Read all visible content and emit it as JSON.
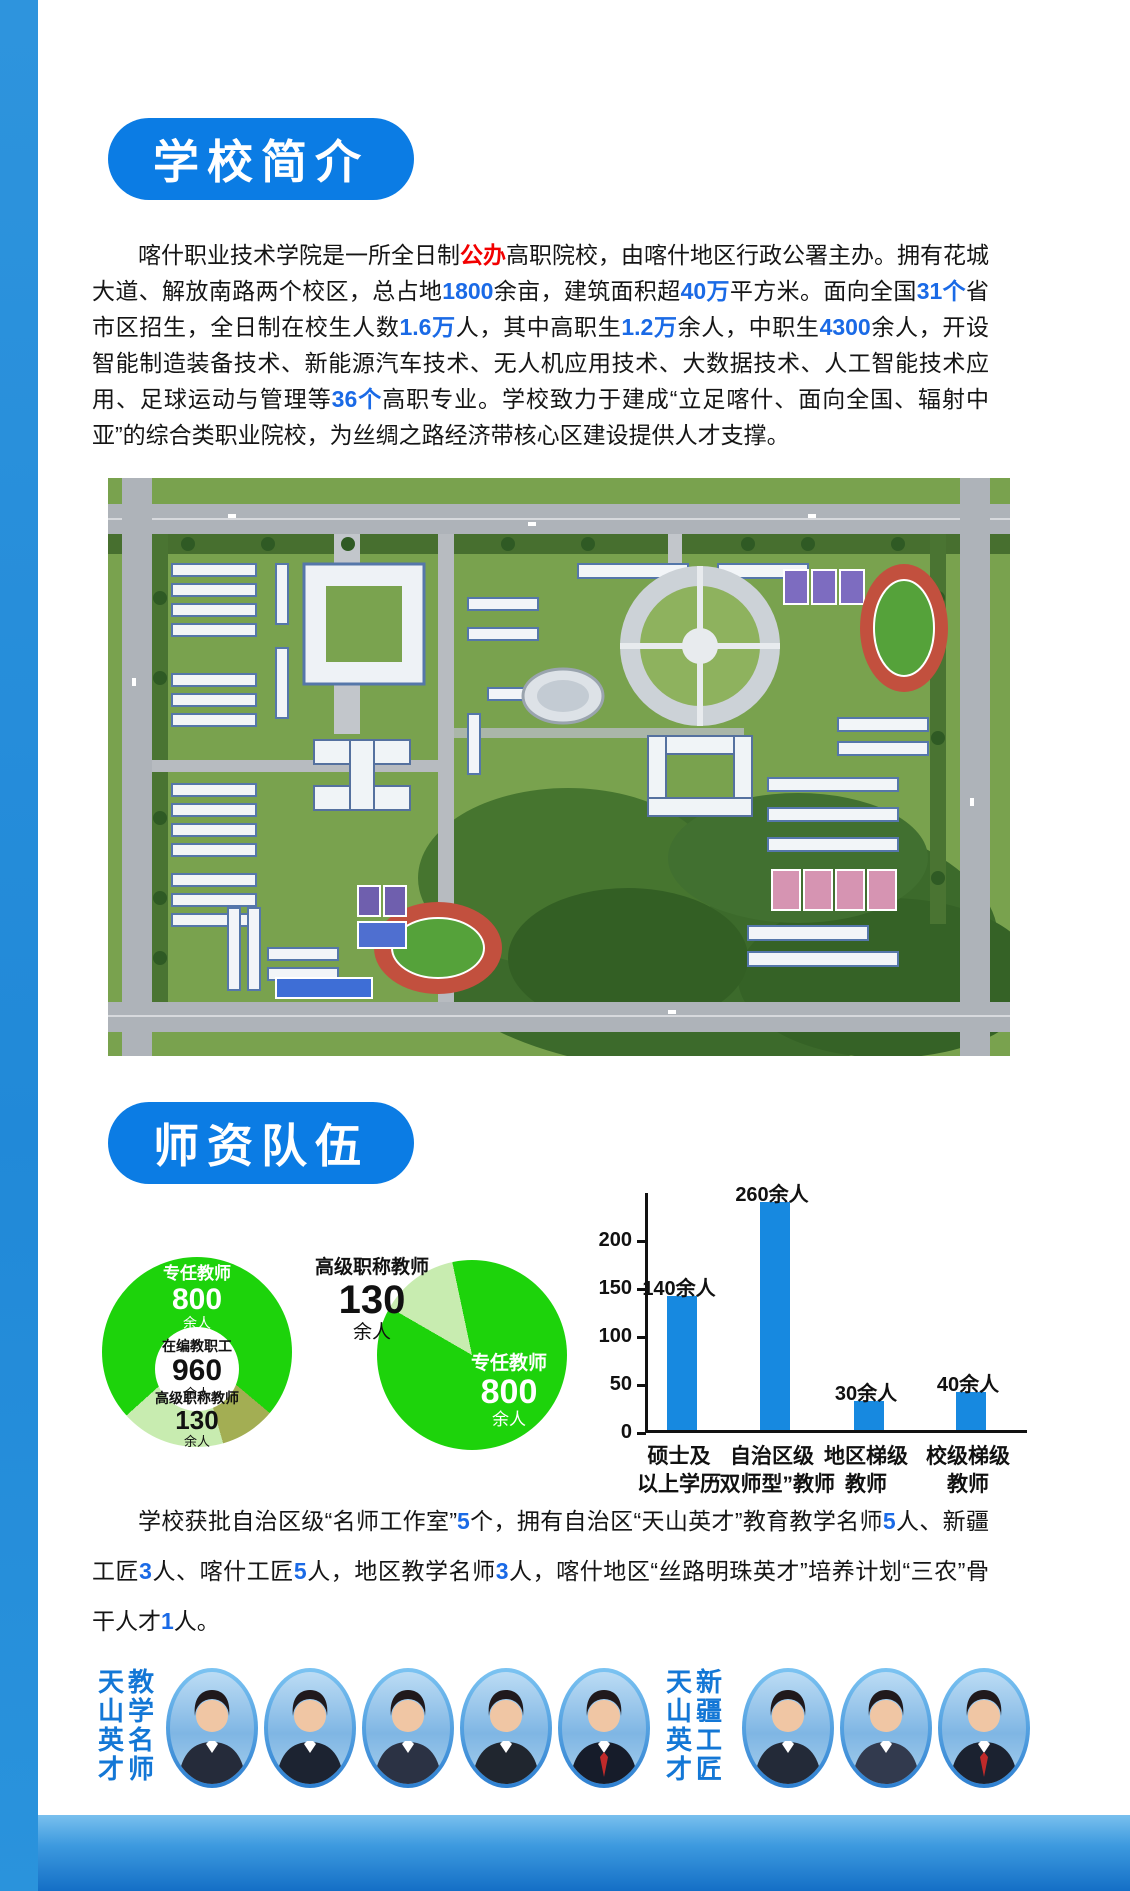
{
  "colors": {
    "accent_blue": "#0b7ce4",
    "number_blue": "#1a6ae6",
    "number_red": "#f20000",
    "bar_blue": "#1789e0",
    "pie_green": "#1dd30b",
    "pie_light_green": "#c8ecb0",
    "pie_olive": "#a3ae53",
    "honor_label_blue": "#1377d6"
  },
  "intro": {
    "badge": "学校简介",
    "paragraph": [
      {
        "t": "喀什职业技术学院是一所全日制"
      },
      {
        "t": "公办",
        "c": "red"
      },
      {
        "t": "高职院校，由喀什地区行政公署主办。拥有花城大道、解放南路两个校区，总占地"
      },
      {
        "t": "1800",
        "c": "blue"
      },
      {
        "t": "余亩，建筑面积超"
      },
      {
        "t": "40万",
        "c": "blue"
      },
      {
        "t": "平方米。面向全国"
      },
      {
        "t": "31个",
        "c": "blue"
      },
      {
        "t": "省市区招生，全日制在校生人数"
      },
      {
        "t": "1.6万",
        "c": "blue"
      },
      {
        "t": "人，其中高职生"
      },
      {
        "t": "1.2万",
        "c": "blue"
      },
      {
        "t": "余人，中职生"
      },
      {
        "t": "4300",
        "c": "blue"
      },
      {
        "t": "余人，开设智能制造装备技术、新能源汽车技术、无人机应用技术、大数据技术、人工智能技术应用、足球运动与管理等"
      },
      {
        "t": "36个",
        "c": "blue"
      },
      {
        "t": "高职专业。学校致力于建成“立足喀什、面向全国、辐射中亚”的综合类职业院校，为丝绸之路经济带核心区建设提供人才支撑。"
      }
    ],
    "campus_photo_alt": "校园鸟瞰图"
  },
  "faculty": {
    "badge": "师资队伍",
    "paragraph": [
      {
        "t": "学校获批自治区级“名师工作室”"
      },
      {
        "t": "5",
        "c": "blue"
      },
      {
        "t": "个，拥有自治区“天山英才”教育教学名师"
      },
      {
        "t": "5",
        "c": "blue"
      },
      {
        "t": "人、新疆工匠"
      },
      {
        "t": "3",
        "c": "blue"
      },
      {
        "t": "人、喀什工匠"
      },
      {
        "t": "5",
        "c": "blue"
      },
      {
        "t": "人，地区教学名师"
      },
      {
        "t": "3",
        "c": "blue"
      },
      {
        "t": "人，喀什地区“丝路明珠英才”培养计划“三农”骨干人才"
      },
      {
        "t": "1",
        "c": "blue"
      },
      {
        "t": "人。"
      }
    ],
    "honors": {
      "group1": {
        "label_left": "天山英才",
        "label_right": "教学名师",
        "photo_count": 5
      },
      "group2": {
        "label_left": "天山英才",
        "label_right": "新疆工匠",
        "photo_count": 3
      }
    }
  },
  "chart_data": [
    {
      "type": "pie",
      "variant": "donut",
      "start_deg": 164,
      "slices": [
        {
          "label": "高级职称教师",
          "value": 130,
          "sweep_deg": 64,
          "color": "#c8ecb0"
        },
        {
          "label": "专任教师",
          "value": 800,
          "sweep_deg": 262,
          "color": "#1dd30b"
        },
        {
          "label": "其他",
          "value": 30,
          "sweep_deg": 34,
          "color": "#a3ae53"
        }
      ],
      "ring_label": {
        "title": "专任教师",
        "value": "800",
        "unit": "余人"
      },
      "center": {
        "title": "在编教职工",
        "value": "960",
        "unit": "余人"
      },
      "bottom_label": {
        "title": "高级职称教师",
        "value": "130",
        "unit": "余人"
      }
    },
    {
      "type": "pie",
      "start_deg": 300,
      "slices": [
        {
          "label": "高级职称教师",
          "value": 130,
          "sweep_deg": 48,
          "color": "#c8ecb0"
        },
        {
          "label": "专任教师",
          "value": 800,
          "sweep_deg": 312,
          "color": "#1dd30b"
        }
      ],
      "outside_label": {
        "title": "高级职称教师",
        "value": "130",
        "unit": "余人"
      },
      "inside_label": {
        "title": "专任教师",
        "value": "800",
        "unit": "余人"
      }
    },
    {
      "type": "bar",
      "categories": [
        [
          "硕士及",
          "以上学历"
        ],
        [
          "自治区级",
          "“双师型”教师"
        ],
        [
          "地区梯级",
          "教师"
        ],
        [
          "校级梯级",
          "教师"
        ]
      ],
      "values": [
        140,
        260,
        30,
        40
      ],
      "value_labels": [
        "140余人",
        "260余人",
        "30余人",
        "40余人"
      ],
      "yticks": [
        200,
        150,
        100,
        50,
        0
      ],
      "ylim": [
        0,
        250
      ],
      "bar_color": "#1789e0",
      "grid": false,
      "legend": "none"
    }
  ]
}
